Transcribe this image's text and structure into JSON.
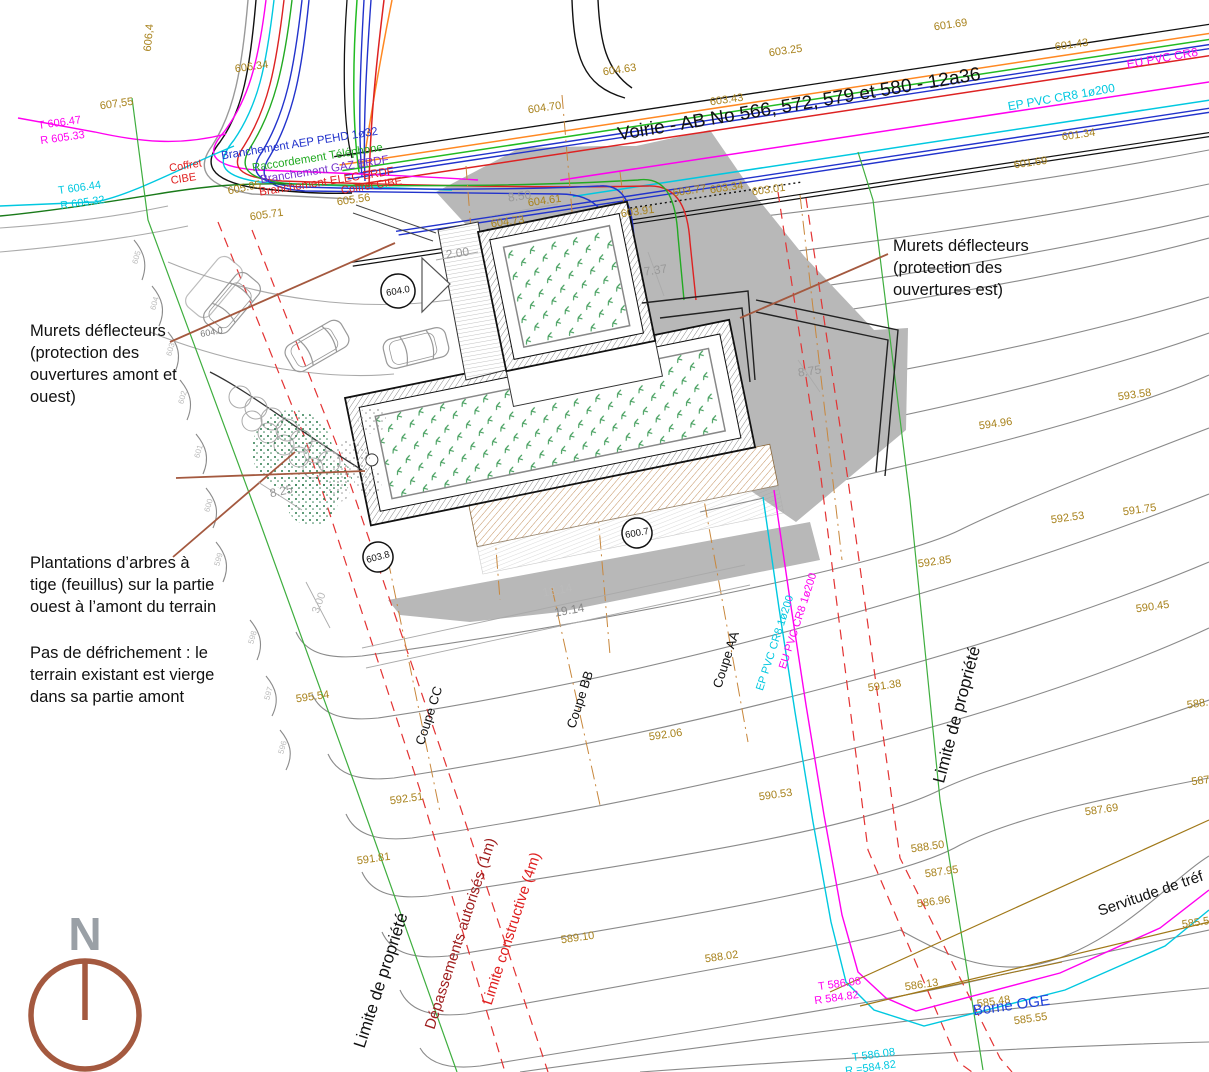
{
  "title": "Plan de masse - Voirie AB No 566, 572, 579 et 580",
  "colors": {
    "brown_elev": "#a8821c",
    "dim_gray": "#999999",
    "black": "#111111",
    "red": "#e02020",
    "dark_red": "#9e1c1c",
    "magenta": "#ff00f0",
    "cyan": "#00c8e0",
    "blue": "#2233cc",
    "violet": "#7733cc",
    "green_line": "#3fae3f",
    "text_blue": "#2244dd",
    "sienna": "#a4593f",
    "contour": "#8a8a8a",
    "shadow": "#b8b8b8",
    "olive": "#a07818",
    "orange": "#ff8822"
  },
  "north": {
    "letter": "N"
  },
  "bubbles": [
    {
      "t": "604.0",
      "x": 398,
      "y": 291,
      "r": -10,
      "rad": 17
    },
    {
      "t": "603.8",
      "x": 378,
      "y": 557,
      "r": -15,
      "rad": 15
    },
    {
      "t": "600.7",
      "x": 637,
      "y": 533,
      "r": -10,
      "rad": 15
    }
  ],
  "labels": [
    {
      "t": "606,4",
      "x": 152,
      "y": 38,
      "r": -85,
      "c": "#a8821c",
      "s": 11
    },
    {
      "t": "606.34",
      "x": 252,
      "y": 70,
      "r": -8,
      "c": "#a8821c",
      "s": 11
    },
    {
      "t": "607,55",
      "x": 117,
      "y": 107,
      "r": -8,
      "c": "#a8821c",
      "s": 11
    },
    {
      "t": "T 606.47",
      "x": 60,
      "y": 126,
      "r": -8,
      "c": "#ff00f0",
      "s": 11
    },
    {
      "t": "R 605.33",
      "x": 63,
      "y": 141,
      "r": -8,
      "c": "#ff00f0",
      "s": 11
    },
    {
      "t": "T 606.44",
      "x": 80,
      "y": 191,
      "r": -8,
      "c": "#00c8e0",
      "s": 11
    },
    {
      "t": "R 605.32",
      "x": 83,
      "y": 206,
      "r": -8,
      "c": "#00c8e0",
      "s": 11
    },
    {
      "t": "Coffret",
      "x": 186,
      "y": 169,
      "r": -9,
      "c": "#e02020",
      "s": 11
    },
    {
      "t": "CIBE",
      "x": 184,
      "y": 182,
      "r": -9,
      "c": "#e02020",
      "s": 11
    },
    {
      "t": "Branchement AEP PEHD 1ø32",
      "x": 300,
      "y": 147,
      "r": -9,
      "c": "#2233cc",
      "s": 11.5
    },
    {
      "t": "Raccordement Téléphone",
      "x": 318,
      "y": 161,
      "r": -9,
      "c": "#22aa22",
      "s": 11.5
    },
    {
      "t": "Branchement GAZ ERDF",
      "x": 325,
      "y": 173,
      "r": -9,
      "c": "#7733cc",
      "s": 11.5
    },
    {
      "t": "Branchement ELEC ERDF",
      "x": 327,
      "y": 185,
      "r": -9,
      "c": "#e02020",
      "s": 11.5
    },
    {
      "t": "Coffret CIBE",
      "x": 372,
      "y": 189,
      "r": -9,
      "c": "#e02020",
      "s": 11
    },
    {
      "t": "605.95",
      "x": 245,
      "y": 191,
      "r": -12,
      "c": "#a8821c",
      "s": 11
    },
    {
      "t": "605.71",
      "x": 267,
      "y": 218,
      "r": -8,
      "c": "#a8821c",
      "s": 11
    },
    {
      "t": "605.56",
      "x": 354,
      "y": 203,
      "r": -8,
      "c": "#a8821c",
      "s": 11
    },
    {
      "t": "Voirie - AB No 566, 572, 579 et 580 - 12a36",
      "x": 800,
      "y": 110,
      "r": -9.5,
      "c": "#111111",
      "s": 19
    },
    {
      "t": "EU PVC CR8",
      "x": 1163,
      "y": 62,
      "r": -10,
      "c": "#ff00f0",
      "s": 12
    },
    {
      "t": "EP PVC CR8 1ø200",
      "x": 1062,
      "y": 101,
      "r": -10,
      "c": "#00c8e0",
      "s": 12
    },
    {
      "t": "604.70",
      "x": 545,
      "y": 111,
      "r": -8,
      "c": "#a8821c",
      "s": 11
    },
    {
      "t": "604.63",
      "x": 620,
      "y": 73,
      "r": -8,
      "c": "#a8821c",
      "s": 11
    },
    {
      "t": "603.25",
      "x": 786,
      "y": 54,
      "r": -8,
      "c": "#a8821c",
      "s": 11
    },
    {
      "t": "603.43",
      "x": 727,
      "y": 103,
      "r": -8,
      "c": "#a8821c",
      "s": 11
    },
    {
      "t": "601.69",
      "x": 951,
      "y": 28,
      "r": -8,
      "c": "#a8821c",
      "s": 11
    },
    {
      "t": "601.43",
      "x": 1072,
      "y": 48,
      "r": -8,
      "c": "#a8821c",
      "s": 11
    },
    {
      "t": "601.34",
      "x": 1079,
      "y": 138,
      "r": -8,
      "c": "#a8821c",
      "s": 11
    },
    {
      "t": "601.69",
      "x": 1031,
      "y": 166,
      "r": -8,
      "c": "#a8821c",
      "s": 11
    },
    {
      "t": "603.77",
      "x": 690,
      "y": 194,
      "r": -8,
      "c": "#a8821c",
      "s": 11
    },
    {
      "t": "603.34",
      "x": 727,
      "y": 191,
      "r": -8,
      "c": "#a8821c",
      "s": 11
    },
    {
      "t": "603.01",
      "x": 769,
      "y": 193,
      "r": -8,
      "c": "#a8821c",
      "s": 11
    },
    {
      "t": "603.91",
      "x": 638,
      "y": 215,
      "r": -8,
      "c": "#a8821c",
      "s": 11
    },
    {
      "t": "604.61",
      "x": 545,
      "y": 204,
      "r": -8,
      "c": "#a8821c",
      "s": 11
    },
    {
      "t": "604.73",
      "x": 508,
      "y": 225,
      "r": -8,
      "c": "#a8821c",
      "s": 11
    },
    {
      "t": "8.50",
      "x": 520,
      "y": 200,
      "r": -8,
      "c": "#999999",
      "s": 12
    },
    {
      "t": "2.00",
      "x": 458,
      "y": 257,
      "r": -8,
      "c": "#999999",
      "s": 12
    },
    {
      "t": "7.37",
      "x": 656,
      "y": 274,
      "r": -8,
      "c": "#999999",
      "s": 12
    },
    {
      "t": "8.75",
      "x": 810,
      "y": 375,
      "r": -8,
      "c": "#999999",
      "s": 12
    },
    {
      "t": "8.25",
      "x": 282,
      "y": 495,
      "r": -12,
      "c": "#999999",
      "s": 12
    },
    {
      "t": "18.14",
      "x": 558,
      "y": 594,
      "r": -10,
      "c": "#bbbbbb",
      "s": 12
    },
    {
      "t": "19.14",
      "x": 570,
      "y": 614,
      "r": -10,
      "c": "#888888",
      "s": 12
    },
    {
      "t": "3.00",
      "x": 322,
      "y": 604,
      "r": -70,
      "c": "#bbbbbb",
      "s": 11
    },
    {
      "t": "604.0",
      "x": 212,
      "y": 335,
      "r": -10,
      "c": "#777777",
      "s": 9
    },
    {
      "t": "Murets déflecteurs",
      "x": 30,
      "y": 336,
      "r": 0,
      "c": "#111111",
      "s": 16.5,
      "a": "start"
    },
    {
      "t": "(protection des",
      "x": 30,
      "y": 358,
      "r": 0,
      "c": "#111111",
      "s": 16.5,
      "a": "start"
    },
    {
      "t": "ouvertures amont et",
      "x": 30,
      "y": 380,
      "r": 0,
      "c": "#111111",
      "s": 16.5,
      "a": "start"
    },
    {
      "t": "ouest)",
      "x": 30,
      "y": 402,
      "r": 0,
      "c": "#111111",
      "s": 16.5,
      "a": "start"
    },
    {
      "t": "Plantations d’arbres à",
      "x": 30,
      "y": 568,
      "r": 0,
      "c": "#111111",
      "s": 16.5,
      "a": "start"
    },
    {
      "t": "tige (feuillus) sur la partie",
      "x": 30,
      "y": 590,
      "r": 0,
      "c": "#111111",
      "s": 16.5,
      "a": "start"
    },
    {
      "t": "ouest à l’amont du terrain",
      "x": 30,
      "y": 612,
      "r": 0,
      "c": "#111111",
      "s": 16.5,
      "a": "start"
    },
    {
      "t": "Pas de défrichement : le",
      "x": 30,
      "y": 658,
      "r": 0,
      "c": "#111111",
      "s": 16.5,
      "a": "start"
    },
    {
      "t": "terrain existant est vierge",
      "x": 30,
      "y": 680,
      "r": 0,
      "c": "#111111",
      "s": 16.5,
      "a": "start"
    },
    {
      "t": "dans sa partie amont",
      "x": 30,
      "y": 702,
      "r": 0,
      "c": "#111111",
      "s": 16.5,
      "a": "start"
    },
    {
      "t": "Murets déflecteurs",
      "x": 893,
      "y": 251,
      "r": 0,
      "c": "#111111",
      "s": 16.5,
      "a": "start"
    },
    {
      "t": "(protection des",
      "x": 893,
      "y": 273,
      "r": 0,
      "c": "#111111",
      "s": 16.5,
      "a": "start"
    },
    {
      "t": "ouvertures est)",
      "x": 893,
      "y": 295,
      "r": 0,
      "c": "#111111",
      "s": 16.5,
      "a": "start"
    },
    {
      "t": "593.58",
      "x": 1135,
      "y": 398,
      "r": -8,
      "c": "#a8821c",
      "s": 11
    },
    {
      "t": "594.96",
      "x": 996,
      "y": 427,
      "r": -8,
      "c": "#a8821c",
      "s": 11
    },
    {
      "t": "592.53",
      "x": 1068,
      "y": 521,
      "r": -8,
      "c": "#a8821c",
      "s": 11
    },
    {
      "t": "591.75",
      "x": 1140,
      "y": 513,
      "r": -8,
      "c": "#a8821c",
      "s": 11
    },
    {
      "t": "592.85",
      "x": 935,
      "y": 565,
      "r": -8,
      "c": "#a8821c",
      "s": 11
    },
    {
      "t": "590.45",
      "x": 1153,
      "y": 610,
      "r": -8,
      "c": "#a8821c",
      "s": 11
    },
    {
      "t": "592.06",
      "x": 666,
      "y": 738,
      "r": -8,
      "c": "#a8821c",
      "s": 11
    },
    {
      "t": "591.38",
      "x": 885,
      "y": 689,
      "r": -8,
      "c": "#a8821c",
      "s": 11
    },
    {
      "t": "590.53",
      "x": 776,
      "y": 798,
      "r": -8,
      "c": "#a8821c",
      "s": 11
    },
    {
      "t": "595.54",
      "x": 313,
      "y": 700,
      "r": -8,
      "c": "#a8821c",
      "s": 11
    },
    {
      "t": "592.51",
      "x": 407,
      "y": 802,
      "r": -8,
      "c": "#a8821c",
      "s": 11
    },
    {
      "t": "591.81",
      "x": 374,
      "y": 862,
      "r": -8,
      "c": "#a8821c",
      "s": 11
    },
    {
      "t": "589.10",
      "x": 578,
      "y": 941,
      "r": -8,
      "c": "#a8821c",
      "s": 11
    },
    {
      "t": "588.02",
      "x": 722,
      "y": 960,
      "r": -8,
      "c": "#a8821c",
      "s": 11
    },
    {
      "t": "588.50",
      "x": 928,
      "y": 850,
      "r": -8,
      "c": "#a8821c",
      "s": 11
    },
    {
      "t": "587.95",
      "x": 942,
      "y": 875,
      "r": -8,
      "c": "#a8821c",
      "s": 11
    },
    {
      "t": "586.96",
      "x": 934,
      "y": 905,
      "r": -8,
      "c": "#a8821c",
      "s": 11
    },
    {
      "t": "587.69",
      "x": 1102,
      "y": 813,
      "r": -8,
      "c": "#a8821c",
      "s": 11
    },
    {
      "t": "588.",
      "x": 1198,
      "y": 707,
      "r": -8,
      "c": "#a8821c",
      "s": 11
    },
    {
      "t": "587",
      "x": 1201,
      "y": 784,
      "r": -8,
      "c": "#a8821c",
      "s": 11
    },
    {
      "t": "585.5",
      "x": 1196,
      "y": 926,
      "r": -8,
      "c": "#a8821c",
      "s": 11
    },
    {
      "t": "586.13",
      "x": 922,
      "y": 988,
      "r": -8,
      "c": "#a8821c",
      "s": 11
    },
    {
      "t": "585.48",
      "x": 994,
      "y": 1005,
      "r": -8,
      "c": "#a8821c",
      "s": 11
    },
    {
      "t": "585.55",
      "x": 1031,
      "y": 1022,
      "r": -8,
      "c": "#a8821c",
      "s": 11
    },
    {
      "t": "T 586.08",
      "x": 840,
      "y": 987,
      "r": -8,
      "c": "#ff00f0",
      "s": 11
    },
    {
      "t": "R 584.82",
      "x": 837,
      "y": 1001,
      "r": -8,
      "c": "#ff00f0",
      "s": 11
    },
    {
      "t": "T 586.08",
      "x": 874,
      "y": 1058,
      "r": -8,
      "c": "#00c8e0",
      "s": 11
    },
    {
      "t": "R =584.82",
      "x": 871,
      "y": 1071,
      "r": -8,
      "c": "#00c8e0",
      "s": 11
    },
    {
      "t": "Borne OGE",
      "x": 1012,
      "y": 1010,
      "r": -8,
      "c": "#2244dd",
      "s": 15
    },
    {
      "t": "Limite de propriété",
      "x": 386,
      "y": 982,
      "r": -72,
      "c": "#111111",
      "s": 17
    },
    {
      "t": "Limite de propriété",
      "x": 962,
      "y": 716,
      "r": -75,
      "c": "#111111",
      "s": 17
    },
    {
      "t": "Dépassements autorisés (1m)",
      "x": 465,
      "y": 935,
      "r": -72,
      "c": "#9e1c1c",
      "s": 15
    },
    {
      "t": "Limite constructive (4m)",
      "x": 516,
      "y": 930,
      "r": -72,
      "c": "#e02020",
      "s": 15
    },
    {
      "t": "Coupe CC",
      "x": 433,
      "y": 717,
      "r": -72,
      "c": "#111111",
      "s": 13
    },
    {
      "t": "Coupe BB",
      "x": 584,
      "y": 701,
      "r": -72,
      "c": "#111111",
      "s": 13
    },
    {
      "t": "Coupe AA",
      "x": 730,
      "y": 661,
      "r": -72,
      "c": "#111111",
      "s": 13
    },
    {
      "t": "Servitude de tréf",
      "x": 1152,
      "y": 898,
      "r": -19,
      "c": "#111111",
      "s": 15
    },
    {
      "t": "EU PVC CR8 1ø200",
      "x": 801,
      "y": 622,
      "r": -72,
      "c": "#ff00f0",
      "s": 11
    },
    {
      "t": "EP PVC CR8 1ø200",
      "x": 778,
      "y": 644,
      "r": -72,
      "c": "#00c8e0",
      "s": 11
    },
    {
      "t": "605",
      "x": 139,
      "y": 258,
      "r": -75,
      "c": "#bbbbbb",
      "s": 8
    },
    {
      "t": "604",
      "x": 157,
      "y": 304,
      "r": -75,
      "c": "#bbbbbb",
      "s": 8
    },
    {
      "t": "603",
      "x": 173,
      "y": 350,
      "r": -75,
      "c": "#bbbbbb",
      "s": 8
    },
    {
      "t": "602",
      "x": 185,
      "y": 398,
      "r": -75,
      "c": "#bbbbbb",
      "s": 8
    },
    {
      "t": "601",
      "x": 201,
      "y": 452,
      "r": -75,
      "c": "#bbbbbb",
      "s": 8
    },
    {
      "t": "600",
      "x": 211,
      "y": 506,
      "r": -75,
      "c": "#bbbbbb",
      "s": 8
    },
    {
      "t": "599",
      "x": 221,
      "y": 560,
      "r": -75,
      "c": "#bbbbbb",
      "s": 8
    },
    {
      "t": "598",
      "x": 255,
      "y": 638,
      "r": -75,
      "c": "#bbbbbb",
      "s": 8
    },
    {
      "t": "597",
      "x": 271,
      "y": 694,
      "r": -75,
      "c": "#bbbbbb",
      "s": 8
    },
    {
      "t": "596",
      "x": 285,
      "y": 748,
      "r": -75,
      "c": "#bbbbbb",
      "s": 8
    },
    {
      "t": "N",
      "x": 85,
      "y": 950,
      "r": 0,
      "c": "#9aa0a6",
      "s": 46,
      "w": "bold"
    }
  ]
}
